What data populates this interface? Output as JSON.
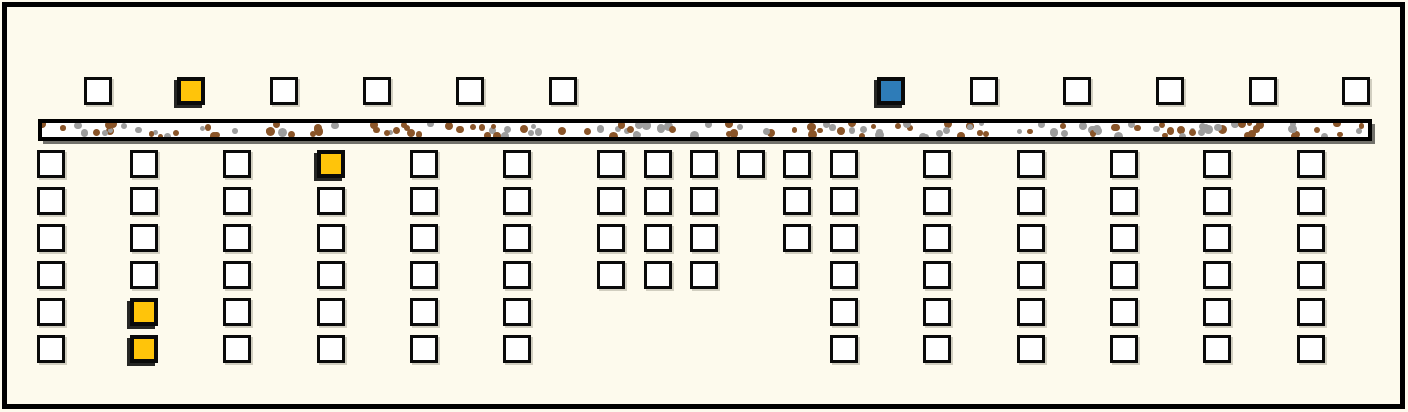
{
  "diagram": {
    "kind": "square-grid-diagram",
    "canvas": {
      "width": 1408,
      "height": 412,
      "background": "#FDFAED",
      "frame_color": "#000000"
    },
    "colors": {
      "square_white": "#FFFFFF",
      "square_yellow": "#FFC40A",
      "square_blue": "#2E7CB8",
      "outline_black": "#0A0A0A",
      "speck_brown": "#8A5529",
      "speck_gray": "#9D9D9D"
    },
    "top_row": {
      "y": 77,
      "square_size": 28,
      "squares": [
        {
          "x": 84,
          "fill": "w"
        },
        {
          "x": 177,
          "fill": "y"
        },
        {
          "x": 270,
          "fill": "w"
        },
        {
          "x": 363,
          "fill": "w"
        },
        {
          "x": 456,
          "fill": "w"
        },
        {
          "x": 549,
          "fill": "w"
        },
        {
          "x": 877,
          "fill": "b"
        },
        {
          "x": 970,
          "fill": "w"
        },
        {
          "x": 1063,
          "fill": "w"
        },
        {
          "x": 1156,
          "fill": "w"
        },
        {
          "x": 1249,
          "fill": "w"
        },
        {
          "x": 1342,
          "fill": "w"
        }
      ]
    },
    "speckled_bar": {
      "x": 38,
      "y": 119,
      "width": 1334,
      "height": 22,
      "speckle": {
        "count": 155,
        "seed": 42,
        "brown_ratio": 0.58,
        "min_radius": 2.5,
        "max_radius": 4.5
      }
    },
    "grid": {
      "square_size": 28,
      "row_y": [
        150,
        187,
        224,
        261,
        298,
        335
      ],
      "columns": [
        {
          "x": 37,
          "rows": [
            "w",
            "w",
            "w",
            "w",
            "w",
            "w"
          ]
        },
        {
          "x": 130,
          "rows": [
            "w",
            "w",
            "w",
            "w",
            "y",
            "y"
          ]
        },
        {
          "x": 223,
          "rows": [
            "w",
            "w",
            "w",
            "w",
            "w",
            "w"
          ]
        },
        {
          "x": 317,
          "rows": [
            "y",
            "w",
            "w",
            "w",
            "w",
            "w"
          ]
        },
        {
          "x": 410,
          "rows": [
            "w",
            "w",
            "w",
            "w",
            "w",
            "w"
          ]
        },
        {
          "x": 503,
          "rows": [
            "w",
            "w",
            "w",
            "w",
            "w",
            "w"
          ]
        },
        {
          "x": 597,
          "rows": [
            "w",
            "w",
            "w",
            "w",
            null,
            null
          ]
        },
        {
          "x": 644,
          "rows": [
            "w",
            "w",
            "w",
            "w",
            null,
            null
          ]
        },
        {
          "x": 690,
          "rows": [
            "w",
            "w",
            "w",
            "w",
            null,
            null
          ]
        },
        {
          "x": 737,
          "rows": [
            "w",
            null,
            null,
            null,
            null,
            null
          ]
        },
        {
          "x": 783,
          "rows": [
            "w",
            "w",
            "w",
            null,
            null,
            null
          ]
        },
        {
          "x": 830,
          "rows": [
            "w",
            "w",
            "w",
            "w",
            "w",
            "w"
          ]
        },
        {
          "x": 923,
          "rows": [
            "w",
            "w",
            "w",
            "w",
            "w",
            "w"
          ]
        },
        {
          "x": 1017,
          "rows": [
            "w",
            "w",
            "w",
            "w",
            "w",
            "w"
          ]
        },
        {
          "x": 1110,
          "rows": [
            "w",
            "w",
            "w",
            "w",
            "w",
            "w"
          ]
        },
        {
          "x": 1203,
          "rows": [
            "w",
            "w",
            "w",
            "w",
            "w",
            "w"
          ]
        },
        {
          "x": 1297,
          "rows": [
            "w",
            "w",
            "w",
            "w",
            "w",
            "w"
          ]
        }
      ]
    }
  }
}
